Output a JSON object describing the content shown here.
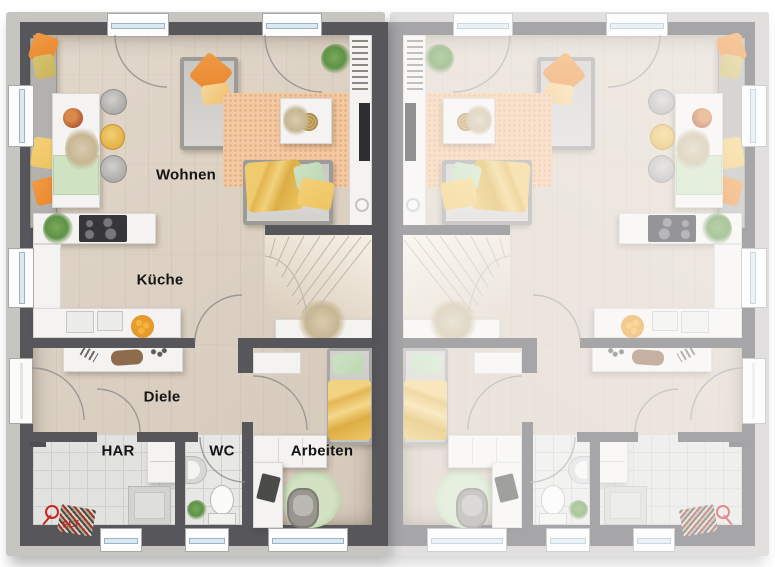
{
  "plan": {
    "rooms": [
      {
        "id": "wohnen",
        "label": "Wohnen"
      },
      {
        "id": "kueche",
        "label": "Küche"
      },
      {
        "id": "diele",
        "label": "Diele"
      },
      {
        "id": "har",
        "label": "HAR"
      },
      {
        "id": "wc",
        "label": "WC"
      },
      {
        "id": "arbeiten",
        "label": "Arbeiten"
      }
    ],
    "annotations": {
      "elt": "ELT"
    }
  },
  "colors": {
    "wall": "#56565b",
    "wall_light_edge": "#c7c5c2",
    "floor_wood": "#dcd2c5",
    "floor_tile": "#e2e2e0",
    "rug": "#f3c9a3",
    "sofa_gray": "#bcbab7",
    "accent_orange": "#e8862d",
    "accent_yellow": "#eec45f",
    "accent_mint": "#bdd8b3",
    "accent_olive": "#c9b35c",
    "counter_white": "#f4f3f1",
    "label_text": "#141414",
    "elt_red": "#c5271f",
    "plant_green": "#5f9147"
  }
}
